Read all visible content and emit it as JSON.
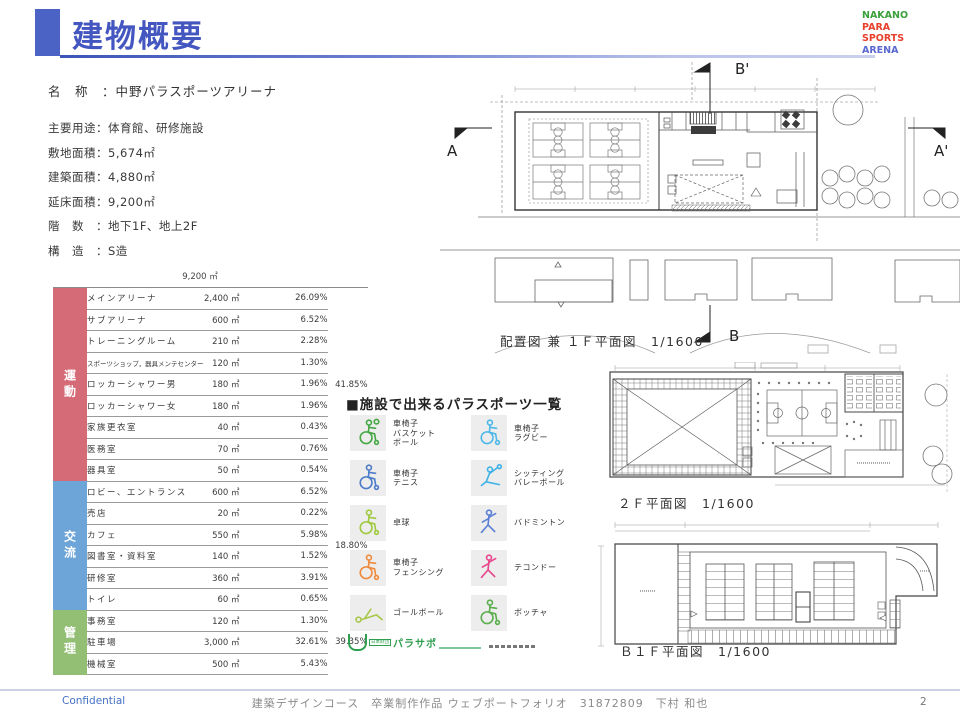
{
  "page": {
    "title": "建物概要"
  },
  "logo": {
    "lines": [
      {
        "text": "NAKANO",
        "color": "#3ba03b"
      },
      {
        "text": "PARA",
        "color": "#e8402d"
      },
      {
        "text": "SPORTS",
        "color": "#e8402d"
      },
      {
        "text": "ARENA",
        "color": "#5a68cf"
      }
    ]
  },
  "building_info": {
    "name_line": "名　称　：中野パラスポーツアリーナ",
    "lines": [
      "主要用途：体育館、研修施設",
      "敷地面積：5,674㎡",
      "建築面積：4,880㎡",
      "延床面積：9,200㎡",
      "階　数　：地下1F、地上2F",
      "構　造　：S造"
    ]
  },
  "area_table": {
    "total": "9,200 ㎡",
    "groups": [
      {
        "category": "運動",
        "color": "#d56b76",
        "group_pct": "41.85%",
        "rows": [
          {
            "name": "メインアリーナ",
            "area": "2,400 ㎡",
            "pct": "26.09%"
          },
          {
            "name": "サブアリーナ",
            "area": "600 ㎡",
            "pct": "6.52%"
          },
          {
            "name": "トレーニングルーム",
            "area": "210 ㎡",
            "pct": "2.28%"
          },
          {
            "name": "スポーツショップ，器具メンテセンター",
            "area": "120 ㎡",
            "pct": "1.30%"
          },
          {
            "name": "ロッカーシャワー男",
            "area": "180 ㎡",
            "pct": "1.96%"
          },
          {
            "name": "ロッカーシャワー女",
            "area": "180 ㎡",
            "pct": "1.96%"
          },
          {
            "name": "家族更衣室",
            "area": "40 ㎡",
            "pct": "0.43%"
          },
          {
            "name": "医務室",
            "area": "70 ㎡",
            "pct": "0.76%"
          },
          {
            "name": "器具室",
            "area": "50 ㎡",
            "pct": "0.54%"
          }
        ]
      },
      {
        "category": "交流",
        "color": "#6ea5d8",
        "group_pct": "18.80%",
        "rows": [
          {
            "name": "ロビー、エントランス",
            "area": "600 ㎡",
            "pct": "6.52%"
          },
          {
            "name": "売店",
            "area": "20 ㎡",
            "pct": "0.22%"
          },
          {
            "name": "カフェ",
            "area": "550 ㎡",
            "pct": "5.98%"
          },
          {
            "name": "図書室・資料室",
            "area": "140 ㎡",
            "pct": "1.52%"
          },
          {
            "name": "研修室",
            "area": "360 ㎡",
            "pct": "3.91%"
          },
          {
            "name": "トイレ",
            "area": "60 ㎡",
            "pct": "0.65%"
          }
        ]
      },
      {
        "category": "管理",
        "color": "#92bf74",
        "group_pct": "39.35%",
        "rows": [
          {
            "name": "事務室",
            "area": "120 ㎡",
            "pct": "1.30%"
          },
          {
            "name": "駐車場",
            "area": "3,000 ㎡",
            "pct": "32.61%"
          },
          {
            "name": "機械室",
            "area": "500 ㎡",
            "pct": "5.43%"
          }
        ]
      }
    ]
  },
  "sports": {
    "heading": "■施設で出来るパラスポーツ一覧",
    "items": [
      {
        "icon": "wheelchair-basketball-icon",
        "label": "車椅子\nバスケット\nボール",
        "color": "#45a845",
        "variant": "wheelchair-ball"
      },
      {
        "icon": "wheelchair-rugby-icon",
        "label": "車椅子\nラグビー",
        "color": "#4fb8e8",
        "variant": "wheelchair"
      },
      {
        "icon": "wheelchair-tennis-icon",
        "label": "車椅子\nテニス",
        "color": "#4d7cc9",
        "variant": "wheelchair"
      },
      {
        "icon": "sitting-volleyball-icon",
        "label": "シッティング\nバレーボール",
        "color": "#3fb3e8",
        "variant": "sitting"
      },
      {
        "icon": "table-tennis-icon",
        "label": "卓球",
        "color": "#9fc93e",
        "variant": "wheelchair"
      },
      {
        "icon": "badminton-icon",
        "label": "バドミントン",
        "color": "#5b7fd4",
        "variant": "standing"
      },
      {
        "icon": "wheelchair-fencing-icon",
        "label": "車椅子\nフェンシング",
        "color": "#f08a3c",
        "variant": "wheelchair"
      },
      {
        "icon": "taekwondo-icon",
        "label": "テコンドー",
        "color": "#e8468c",
        "variant": "standing"
      },
      {
        "icon": "goalball-icon",
        "label": "ゴールボール",
        "color": "#a8c84a",
        "variant": "lying"
      },
      {
        "icon": "boccia-icon",
        "label": "ボッチャ",
        "color": "#5cae4e",
        "variant": "wheelchair"
      }
    ],
    "credit": {
      "org": "日本財団",
      "name": "パラサポ"
    }
  },
  "plans": {
    "plan1": {
      "caption": "配置図 兼 １Ｆ平面図　1/1600",
      "markers": {
        "a": "A",
        "a_prime": "A'",
        "b": "B",
        "b_prime": "B'"
      }
    },
    "plan2": {
      "caption": "２Ｆ平面図　1/1600"
    },
    "plan3": {
      "caption": "Ｂ１Ｆ平面図　1/1600"
    }
  },
  "footer": {
    "confidential": "Confidential",
    "center": "建築デザインコース　卒業制作作品 ウェブポートフォリオ　31872809　下村 和也",
    "page": "2"
  }
}
